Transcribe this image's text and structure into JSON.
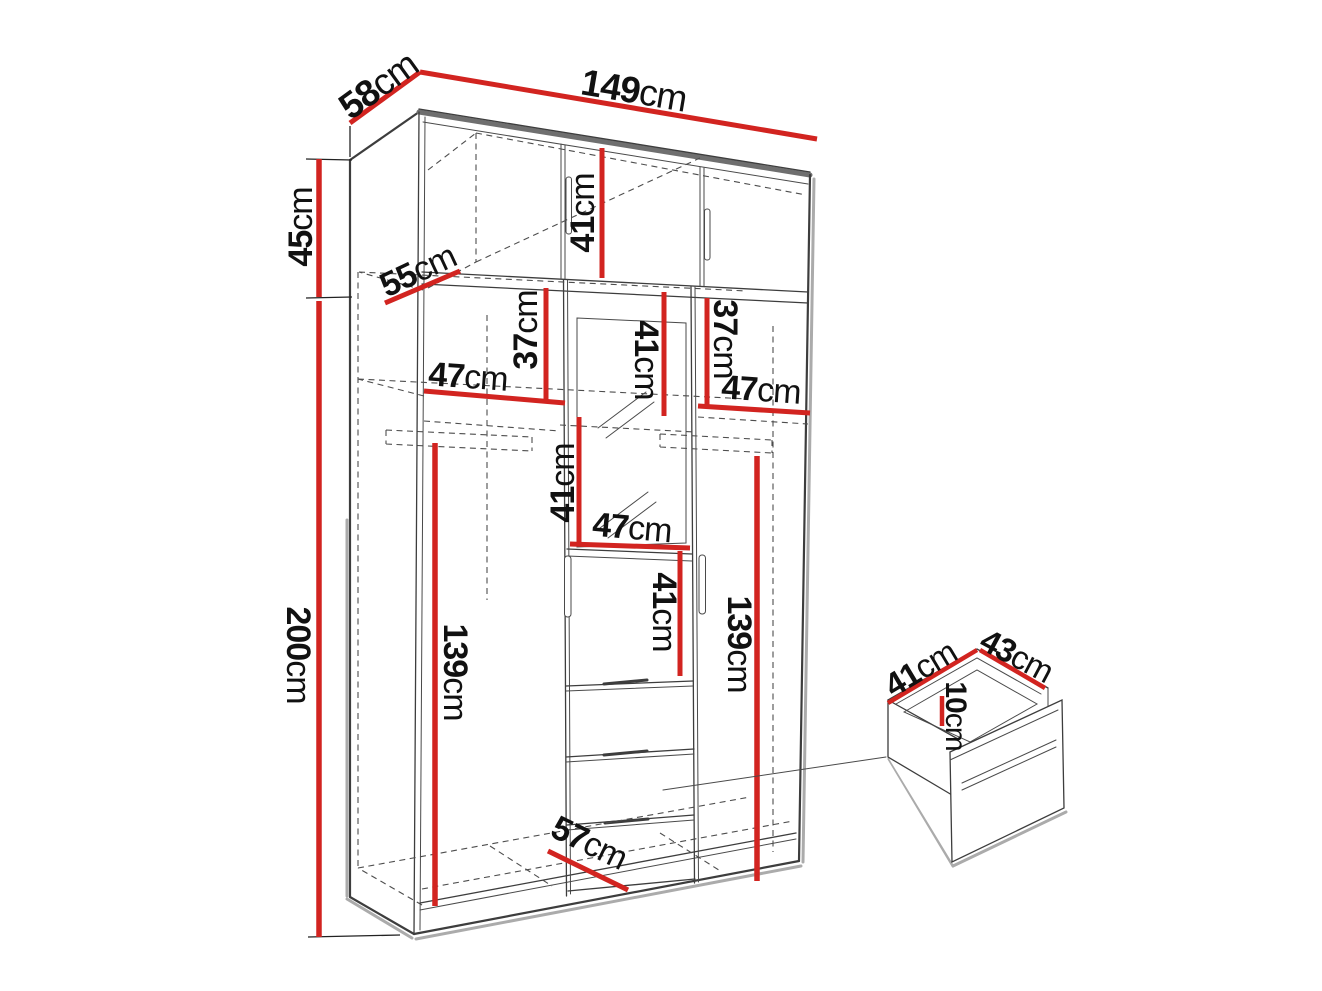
{
  "diagram": {
    "type": "furniture-dimension-diagram",
    "views": {
      "main": "wardrobe-perspective-view",
      "detail": "drawer-detail-view"
    },
    "unit": "cm",
    "dimensions": {
      "width_top": {
        "value": "149",
        "unit": "cm"
      },
      "depth_top": {
        "value": "58",
        "unit": "cm"
      },
      "height_upper_section": {
        "value": "45",
        "unit": "cm"
      },
      "height_main_section": {
        "value": "200",
        "unit": "cm"
      },
      "depth_upper_shelf": {
        "value": "55",
        "unit": "cm"
      },
      "height_upper_cabinet": {
        "value": "41",
        "unit": "cm"
      },
      "gap_shelf_left": {
        "value": "37",
        "unit": "cm"
      },
      "gap_shelf_right": {
        "value": "37",
        "unit": "cm"
      },
      "width_shelf_left": {
        "value": "47",
        "unit": "cm"
      },
      "width_shelf_right": {
        "value": "47",
        "unit": "cm"
      },
      "height_center_upper": {
        "value": "41",
        "unit": "cm"
      },
      "height_center_mirror": {
        "value": "41",
        "unit": "cm"
      },
      "width_shelf_center": {
        "value": "47",
        "unit": "cm"
      },
      "height_center_lower": {
        "value": "41",
        "unit": "cm"
      },
      "height_hanging_left": {
        "value": "139",
        "unit": "cm"
      },
      "height_hanging_right": {
        "value": "139",
        "unit": "cm"
      },
      "depth_bottom": {
        "value": "57",
        "unit": "cm"
      },
      "drawer_width": {
        "value": "41",
        "unit": "cm"
      },
      "drawer_depth": {
        "value": "43",
        "unit": "cm"
      },
      "drawer_height": {
        "value": "10",
        "unit": "cm"
      }
    },
    "colors": {
      "dimension_line": "#d22420",
      "outline": "#3d3d3d",
      "shadow": "#ababab",
      "label": "#111111",
      "background": "#ffffff"
    }
  }
}
